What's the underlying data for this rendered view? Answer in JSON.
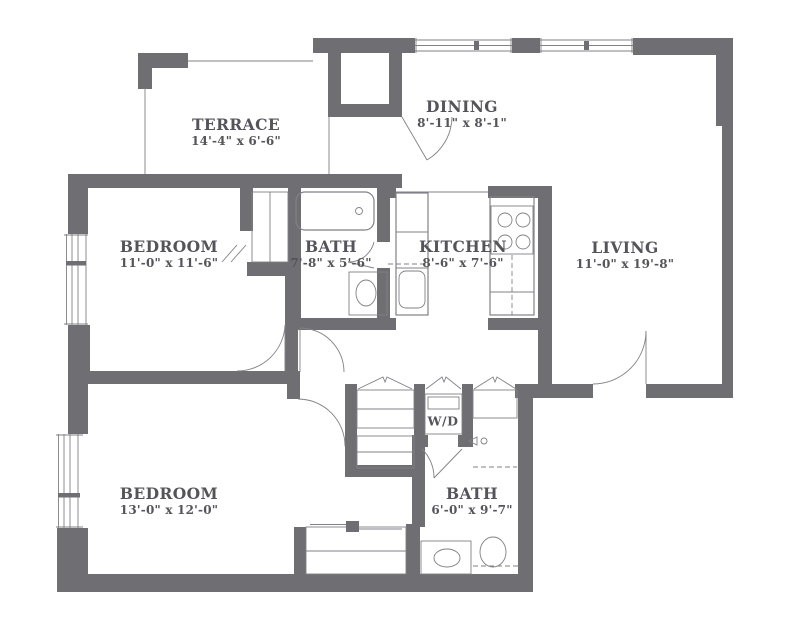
{
  "plan": {
    "colors": {
      "wall": "#6f6f73",
      "line": "#818186",
      "text": "#54545a"
    },
    "rooms": [
      {
        "id": "terrace",
        "name": "TERRACE",
        "dims": "14'-4\" x 6'-6\""
      },
      {
        "id": "dining",
        "name": "DINING",
        "dims": "8'-11\" x 8'-1\""
      },
      {
        "id": "bedroom1",
        "name": "BEDROOM",
        "dims": "11'-0\" x 11'-6\""
      },
      {
        "id": "bath1",
        "name": "BATH",
        "dims": "7'-8\" x 5'-6\""
      },
      {
        "id": "kitchen",
        "name": "KITCHEN",
        "dims": "8'-6\" x 7'-6\""
      },
      {
        "id": "living",
        "name": "LIVING",
        "dims": "11'-0\" x 19'-8\""
      },
      {
        "id": "bedroom2",
        "name": "BEDROOM",
        "dims": "13'-0\" x 12'-0\""
      },
      {
        "id": "bath2",
        "name": "BATH",
        "dims": "6'-0\" x 9'-7\""
      }
    ],
    "appliances": {
      "washer_dryer": "W/D"
    }
  }
}
